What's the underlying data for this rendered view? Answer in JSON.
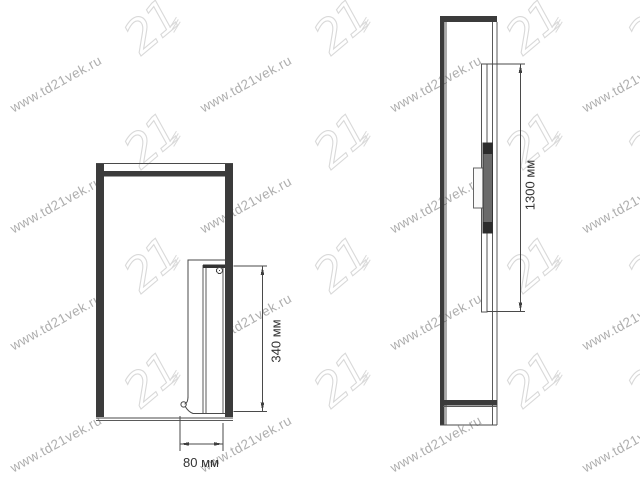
{
  "watermark": {
    "url_text": "www.td21vek.ru",
    "logo_text": "21",
    "text_color": "#aeaeae",
    "logo_color": "#d9d9d9"
  },
  "drawing": {
    "line_color": "#4a4a4a",
    "panel_fill": "#3b3b3b",
    "label_color": "#333333",
    "front_view_name": "front view",
    "side_view_name": "side view"
  },
  "dimensions": {
    "front_height": "340 мм",
    "front_depth": "80 мм",
    "side_height": "1300 мм"
  }
}
